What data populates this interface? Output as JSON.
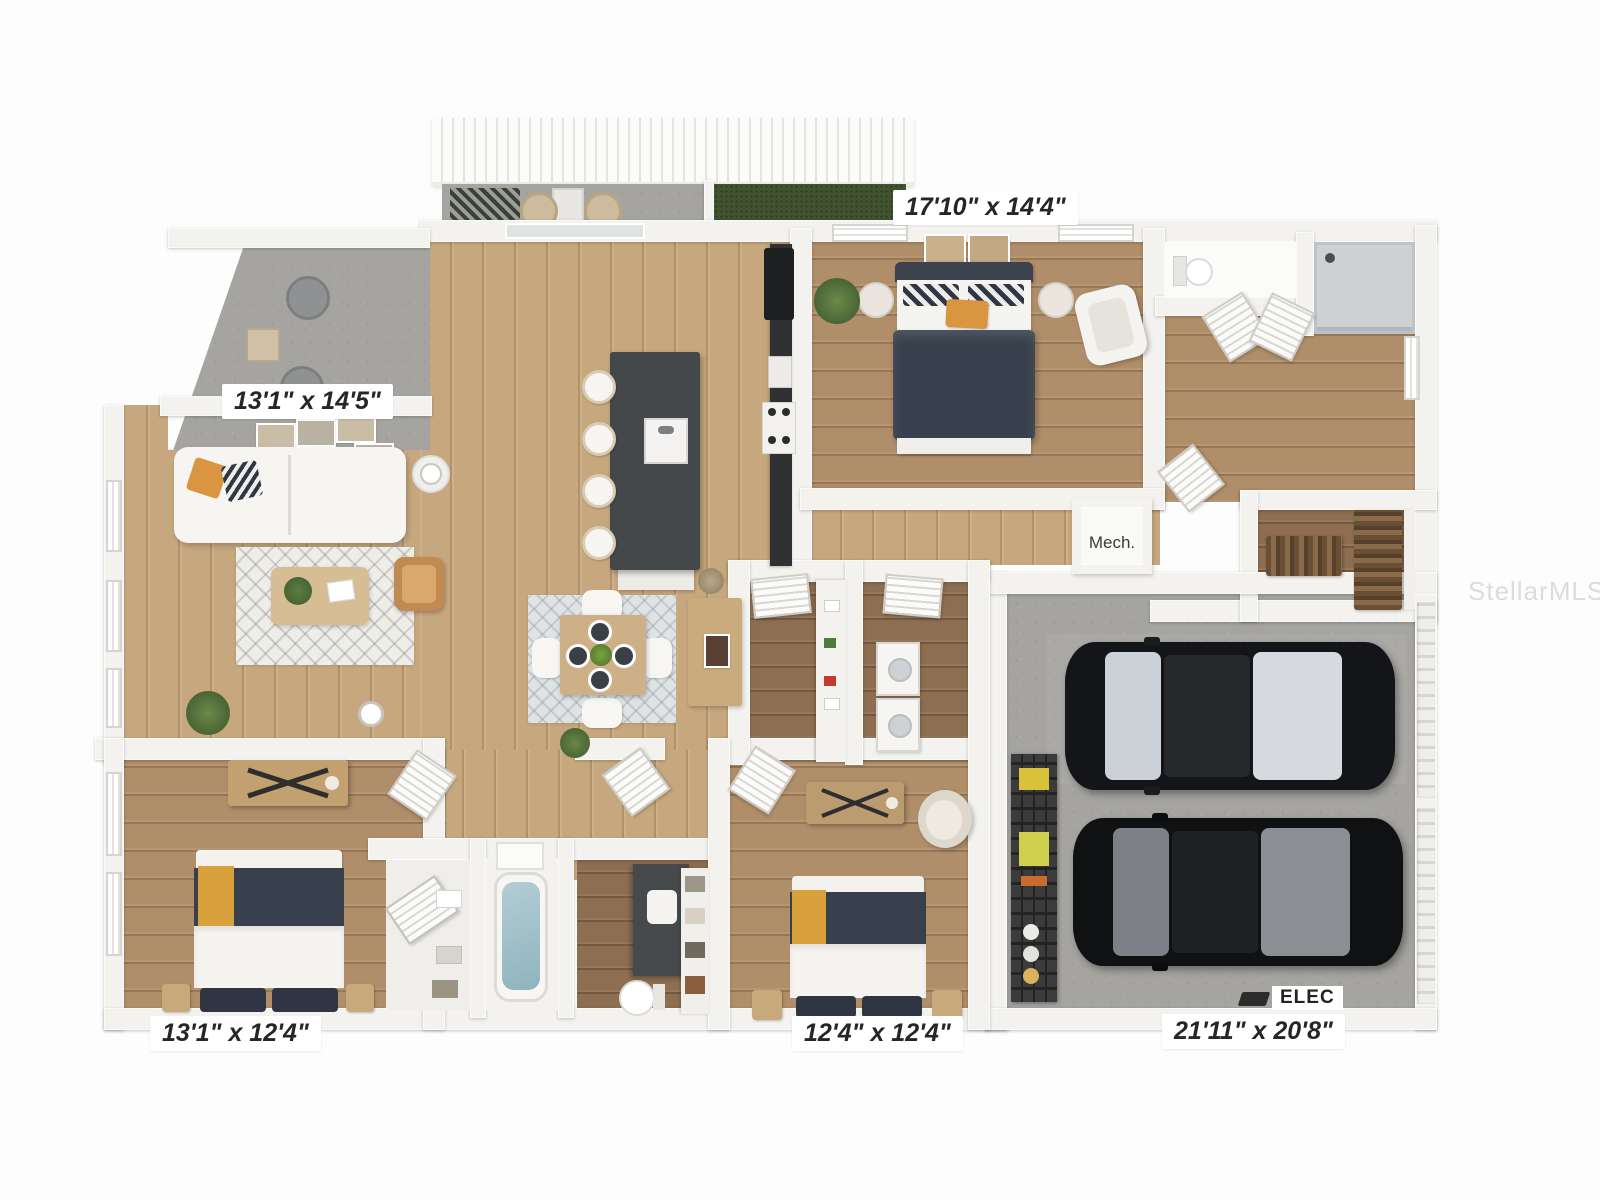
{
  "watermark": "StellarMLS",
  "labels": {
    "master_bedroom": "17'10\" x 14'4\"",
    "living_room": "13'1\" x 14'5\"",
    "bedroom_left": "13'1\" x 12'4\"",
    "bedroom_middle": "12'4\" x 12'4\"",
    "garage": "21'11\" x 20'8\"",
    "mech": "Mech.",
    "elec": "ELEC"
  },
  "colors": {
    "wood_light": "#c7a87e",
    "wood_medium": "#b08e69",
    "wood_dark": "#8d6e51",
    "concrete": "#a5a4a1",
    "turf_green": "#41522e",
    "wall_white": "#f3f2ef",
    "accent_navy": "#39404d",
    "accent_orange": "#d9953f",
    "car_black": "#141518"
  }
}
